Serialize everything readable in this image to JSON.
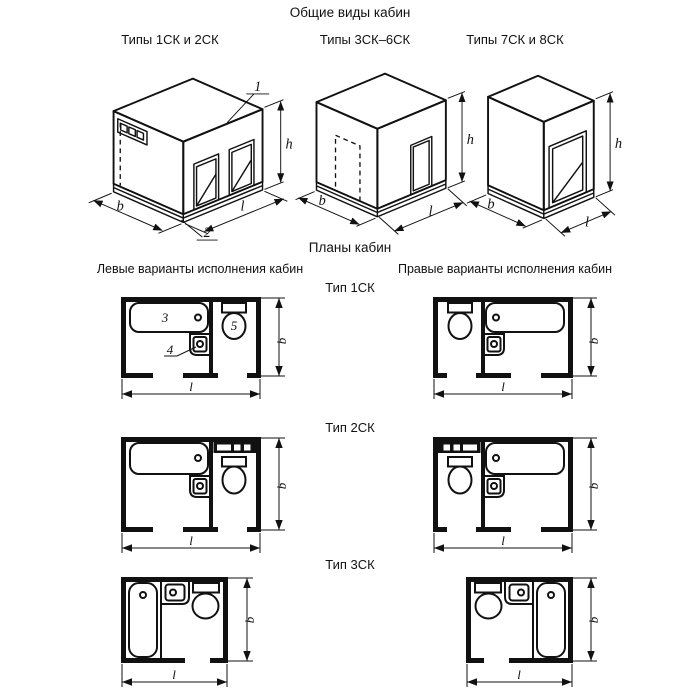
{
  "titles": {
    "general_views": "Общие виды кабин",
    "plans": "Планы кабин",
    "left_column_header": "Левые варианты исполнения кабин",
    "right_column_header": "Правые варианты исполнения кабин"
  },
  "colors": {
    "line": "#111111",
    "background": "#ffffff"
  },
  "dims": {
    "b": "b",
    "l": "l",
    "h": "h"
  },
  "iso_views": [
    {
      "caption": "Типы 1СК и 2СК",
      "callout_top": "1",
      "callout_base": "2"
    },
    {
      "caption": "Типы 3СК–6СК"
    },
    {
      "caption": "Типы 7СК и 8СК"
    }
  ],
  "plan_rows": [
    {
      "type_label": "Тип 1СК",
      "callout_bath": "3",
      "callout_washbasin": "4",
      "callout_toilet": "5"
    },
    {
      "type_label": "Тип 2СК"
    },
    {
      "type_label": "Тип 3СК"
    }
  ]
}
